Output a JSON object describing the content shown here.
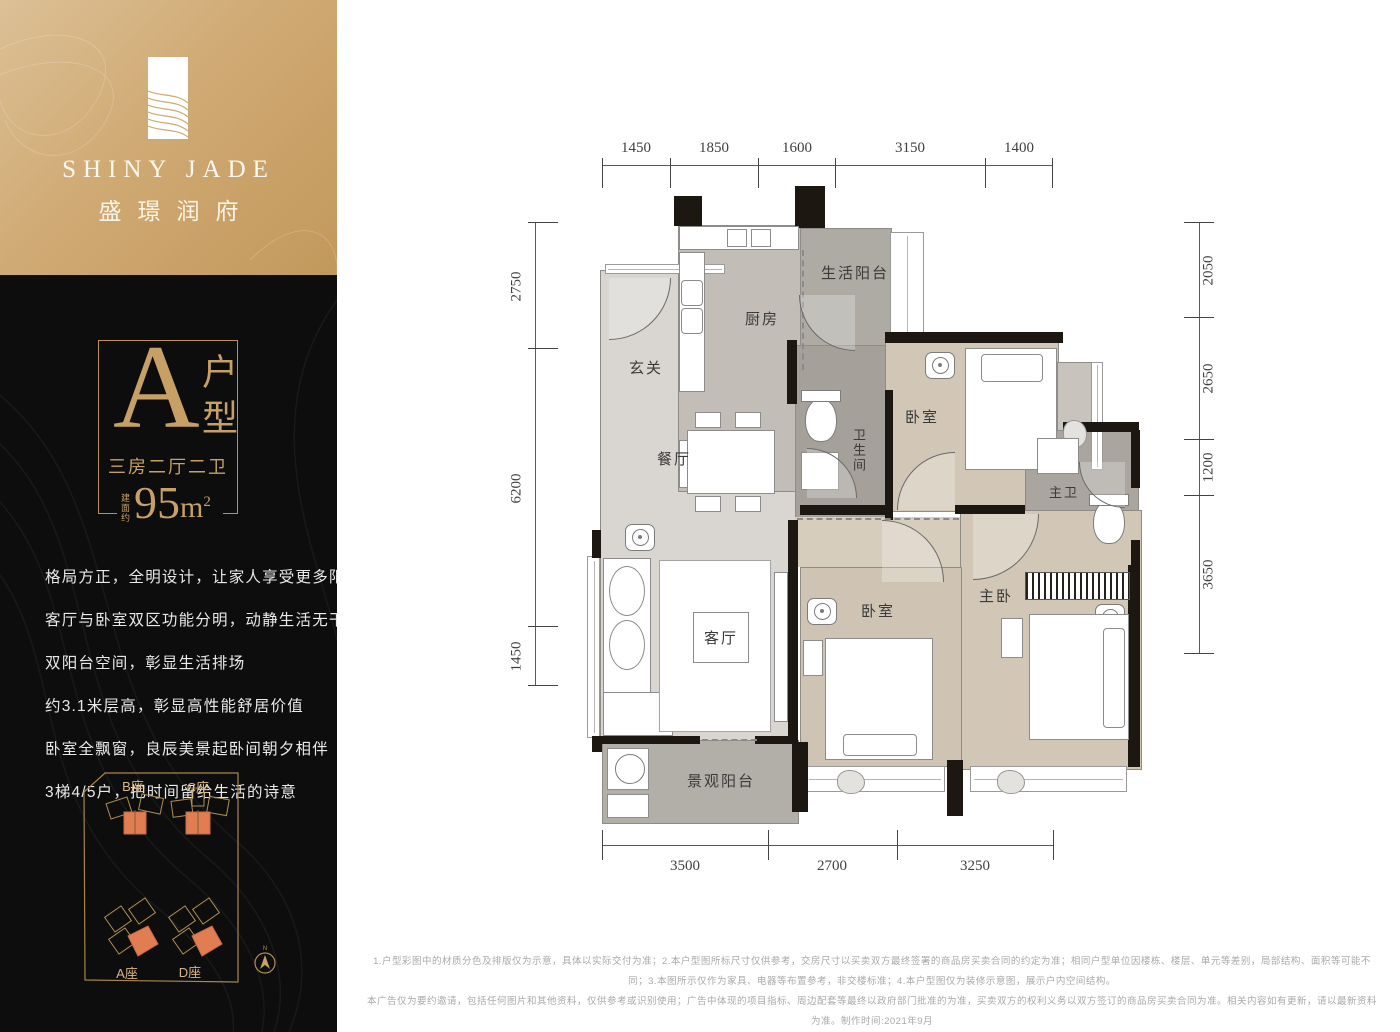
{
  "brand": {
    "name_en": "SHINY JADE",
    "name_cn": "盛璟润府"
  },
  "unit": {
    "type_letter": "A",
    "type_label": "户型",
    "layout": "三房二厅二卫",
    "area_prefix": "建面约",
    "area_value": "95",
    "area_unit": "m",
    "area_sup": "2"
  },
  "description": {
    "lines": [
      "格局方正，全明设计，让家人享受更多阳光呵护",
      "客厅与卧室双区功能分明，动静生活无干扰",
      "双阳台空间，彰显生活排场",
      "约3.1米层高，彰显高性能舒居价值",
      "卧室全飘窗，良辰美景起卧间朝夕相伴",
      "3梯4/5户，把时间留给生活的诗意"
    ]
  },
  "siteplan": {
    "buildings": [
      {
        "label": "B座"
      },
      {
        "label": "C座"
      },
      {
        "label": "A座"
      },
      {
        "label": "D座"
      }
    ],
    "compass_label": "N"
  },
  "plan": {
    "rooms": {
      "entry": "玄关",
      "kitchen": "厨房",
      "laundry_balcony": "生活阳台",
      "dining": "餐厅",
      "bath": "卫生间",
      "bedroom_top": "卧室",
      "master_bath": "主卫",
      "living": "客厅",
      "bedroom_bottom": "卧室",
      "master_bedroom": "主卧",
      "view_balcony": "景观阳台"
    },
    "dims": {
      "top": [
        "1450",
        "1850",
        "1600",
        "3150",
        "1400"
      ],
      "left": [
        "2750",
        "6200",
        "1450"
      ],
      "right": [
        "2050",
        "2650",
        "1200",
        "3650"
      ],
      "bottom": [
        "3500",
        "2700",
        "3250"
      ]
    }
  },
  "disclaimer": {
    "line1": "1.户型彩图中的材质分色及排版仅为示意，具体以实际交付为准；2.本户型图所标尺寸仅供参考，交房尺寸以买卖双方最终签署的商品房买卖合同的约定为准；相同户型单位因楼栋、楼层、单元等差别，局部结构、面积等可能不同；3.本图所示仅作为家具、电器等布置参考，非交楼标准；4.本户型图仅为装修示意图，展示户内空间结构。",
    "line2": "本广告仅为要约邀请，包括任何图片和其他资料，仅供参考或识别使用；广告中体现的项目指标、周边配套等最终以政府部门批准的为准，买卖双方的权利义务以双方签订的商品房买卖合同为准。相关内容如有更新，请以最新资料为准。制作时间:2021年9月"
  },
  "colors": {
    "gold": "#c6a065",
    "gold_bg": "#d0aa74",
    "dark": "#0d0d0d",
    "building_orange": "#e07d52",
    "wall": "#1d1712",
    "floor_light": "#d9d6d1",
    "floor_marble": "#aeaba4",
    "floor_wood": "#d2c7b6"
  }
}
